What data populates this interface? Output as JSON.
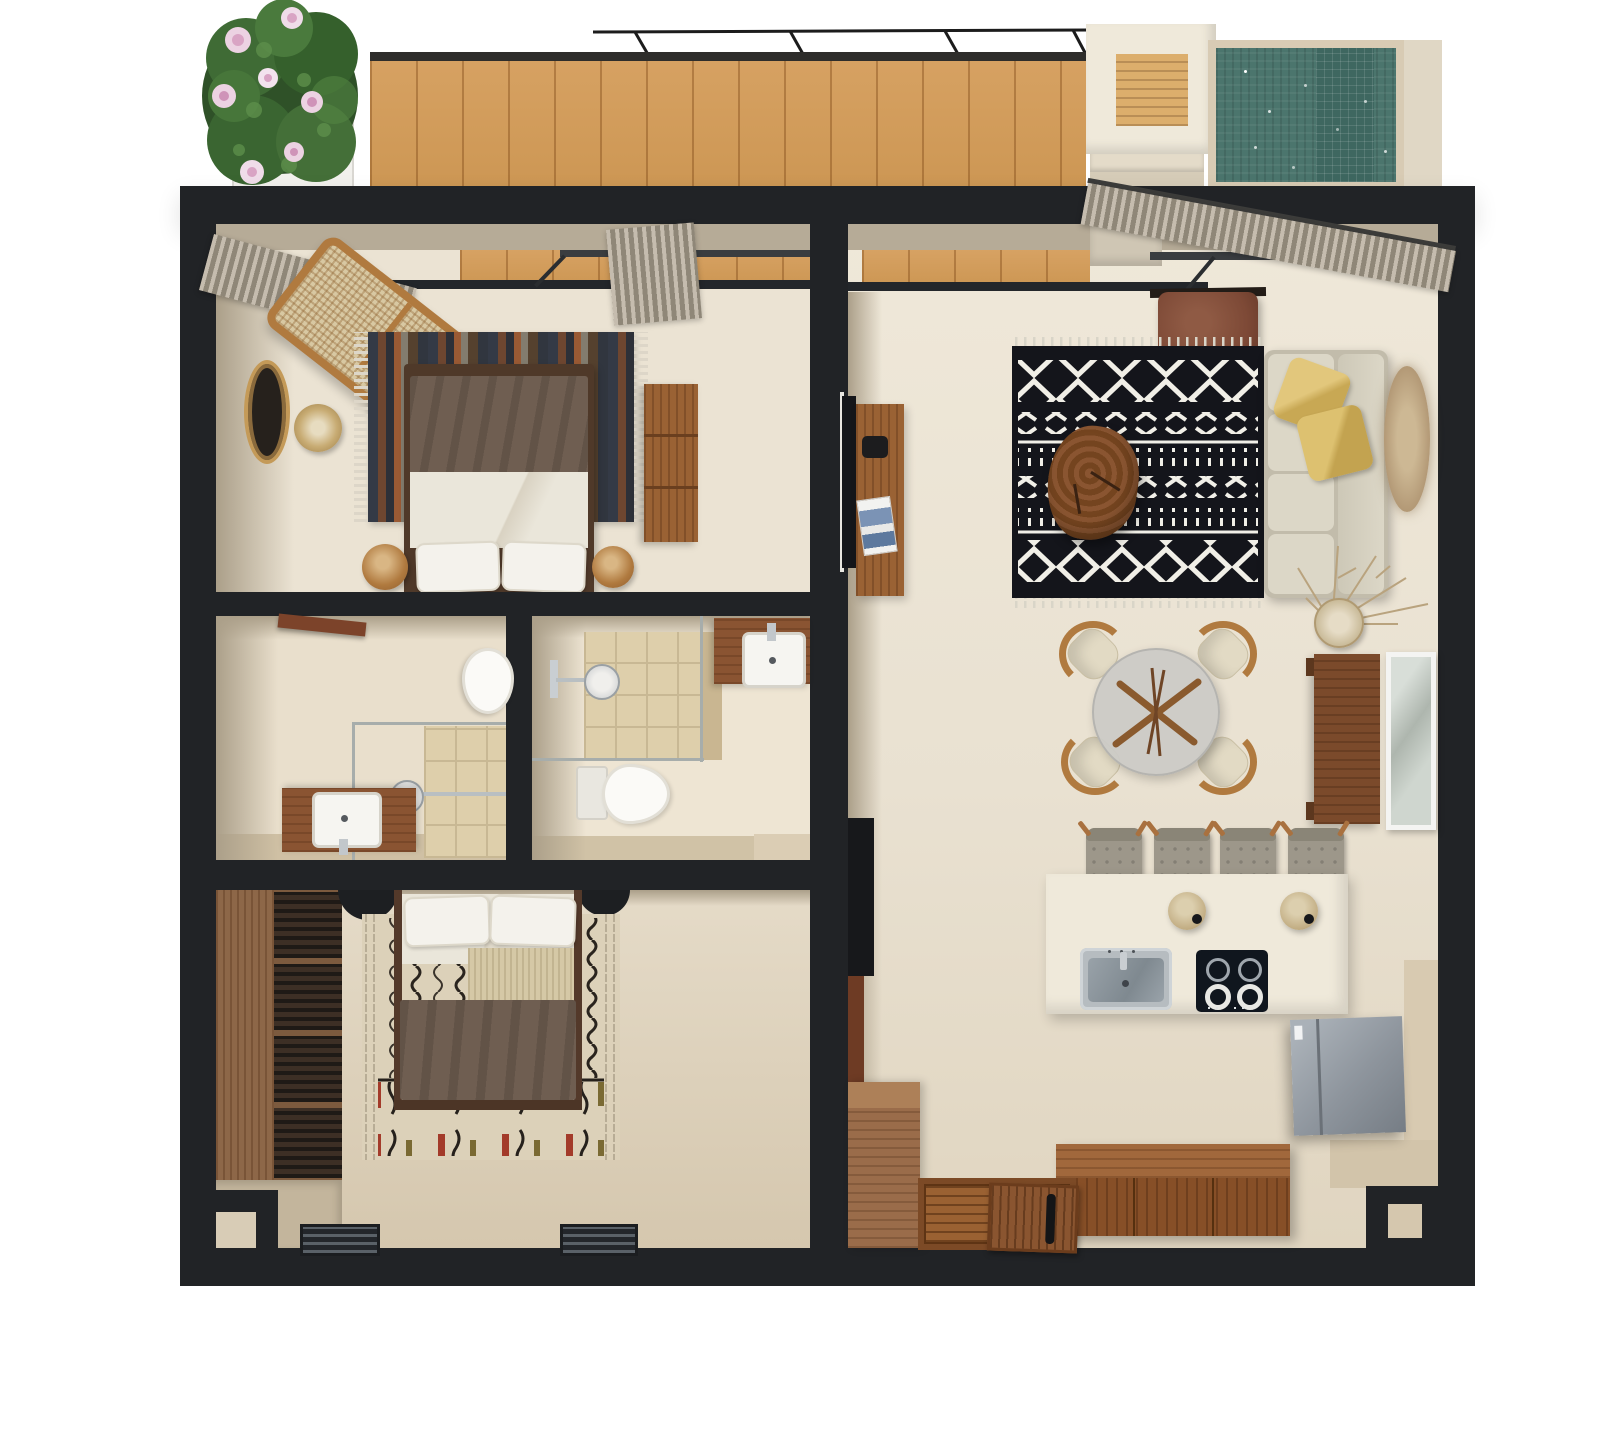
{
  "palette": {
    "wall": "#212326",
    "floor": "#ebe3d3",
    "floorWarm": "#d8cab0",
    "wallFace": "#ab9f89",
    "sill": "#b6ab97",
    "deck": "#d7a263",
    "deckLine": "#b9813f",
    "poolWater": "#4b756d",
    "poolDeep": "#3e6760",
    "poolRim": "#d8cbb4",
    "cream": "#efe9da",
    "woodMid": "#9a6234",
    "woodDark": "#71452a",
    "walnut": "#7b4a2b",
    "rattan": "#b07a3f",
    "weave": "#d8c8a2",
    "tile": "#decfab",
    "tileLine": "#c8b894",
    "glassLine": "#a7adab",
    "curtain": "#c5bcae",
    "curtainDark": "#8f8778",
    "rugDark": "#14151b",
    "rugLight": "#f1efe7",
    "rugCream": "#dcd1b9",
    "sofa": "#d4cfbf",
    "cushion": "#dcd7c7",
    "pillowYellow": "#d8b967",
    "duvet": "#6f5e51",
    "sheet": "#eae6da",
    "leather": "#7d4936",
    "steel": "#aab1b5",
    "fridge": "#8e959d",
    "blackItem": "#1d1f22",
    "plantGreen": "#3f6b35",
    "flowerPink": "#e8c8da",
    "stoolGray": "#9d978a"
  },
  "scene": {
    "type": "3d-floor-plan-top-view",
    "areas": [
      "terrace",
      "plunge-pool",
      "bedroom-1",
      "bathroom-1",
      "bathroom-2",
      "bedroom-2",
      "living-dining-kitchen",
      "entry"
    ]
  },
  "furniture": {
    "terrace": [
      "flowering-plant",
      "wood-deck",
      "pergola-beams",
      "planter-box",
      "steps",
      "plunge-pool"
    ],
    "bedroom1": [
      "curtains",
      "rattan-bench",
      "wall-mirror",
      "basket",
      "striped-rug",
      "double-bed",
      "poufs",
      "dresser"
    ],
    "bathroom1": [
      "door-leaf",
      "toilet",
      "glass-shower",
      "shower-head",
      "vanity-sink"
    ],
    "bathroom2": [
      "glass-shower",
      "shower-head",
      "vanity-sink",
      "toilet"
    ],
    "bedroom2": [
      "slatted-wardrobe",
      "nightstands",
      "patterned-rug",
      "double-bed",
      "floor-vents"
    ],
    "living": [
      "tv-unit",
      "leather-armchair",
      "berber-rug",
      "log-coffee-table",
      "sofa",
      "yellow-pillows",
      "jute-oval-rug",
      "dried-branches-vase",
      "dining-table",
      "dining-chairs",
      "console-table",
      "leaning-mirror",
      "bar-stools",
      "kitchen-island",
      "island-sink",
      "cooktop",
      "pendant-lamps",
      "fridge",
      "sideboard",
      "entry-dresser",
      "entry-door",
      "door-mat"
    ]
  }
}
